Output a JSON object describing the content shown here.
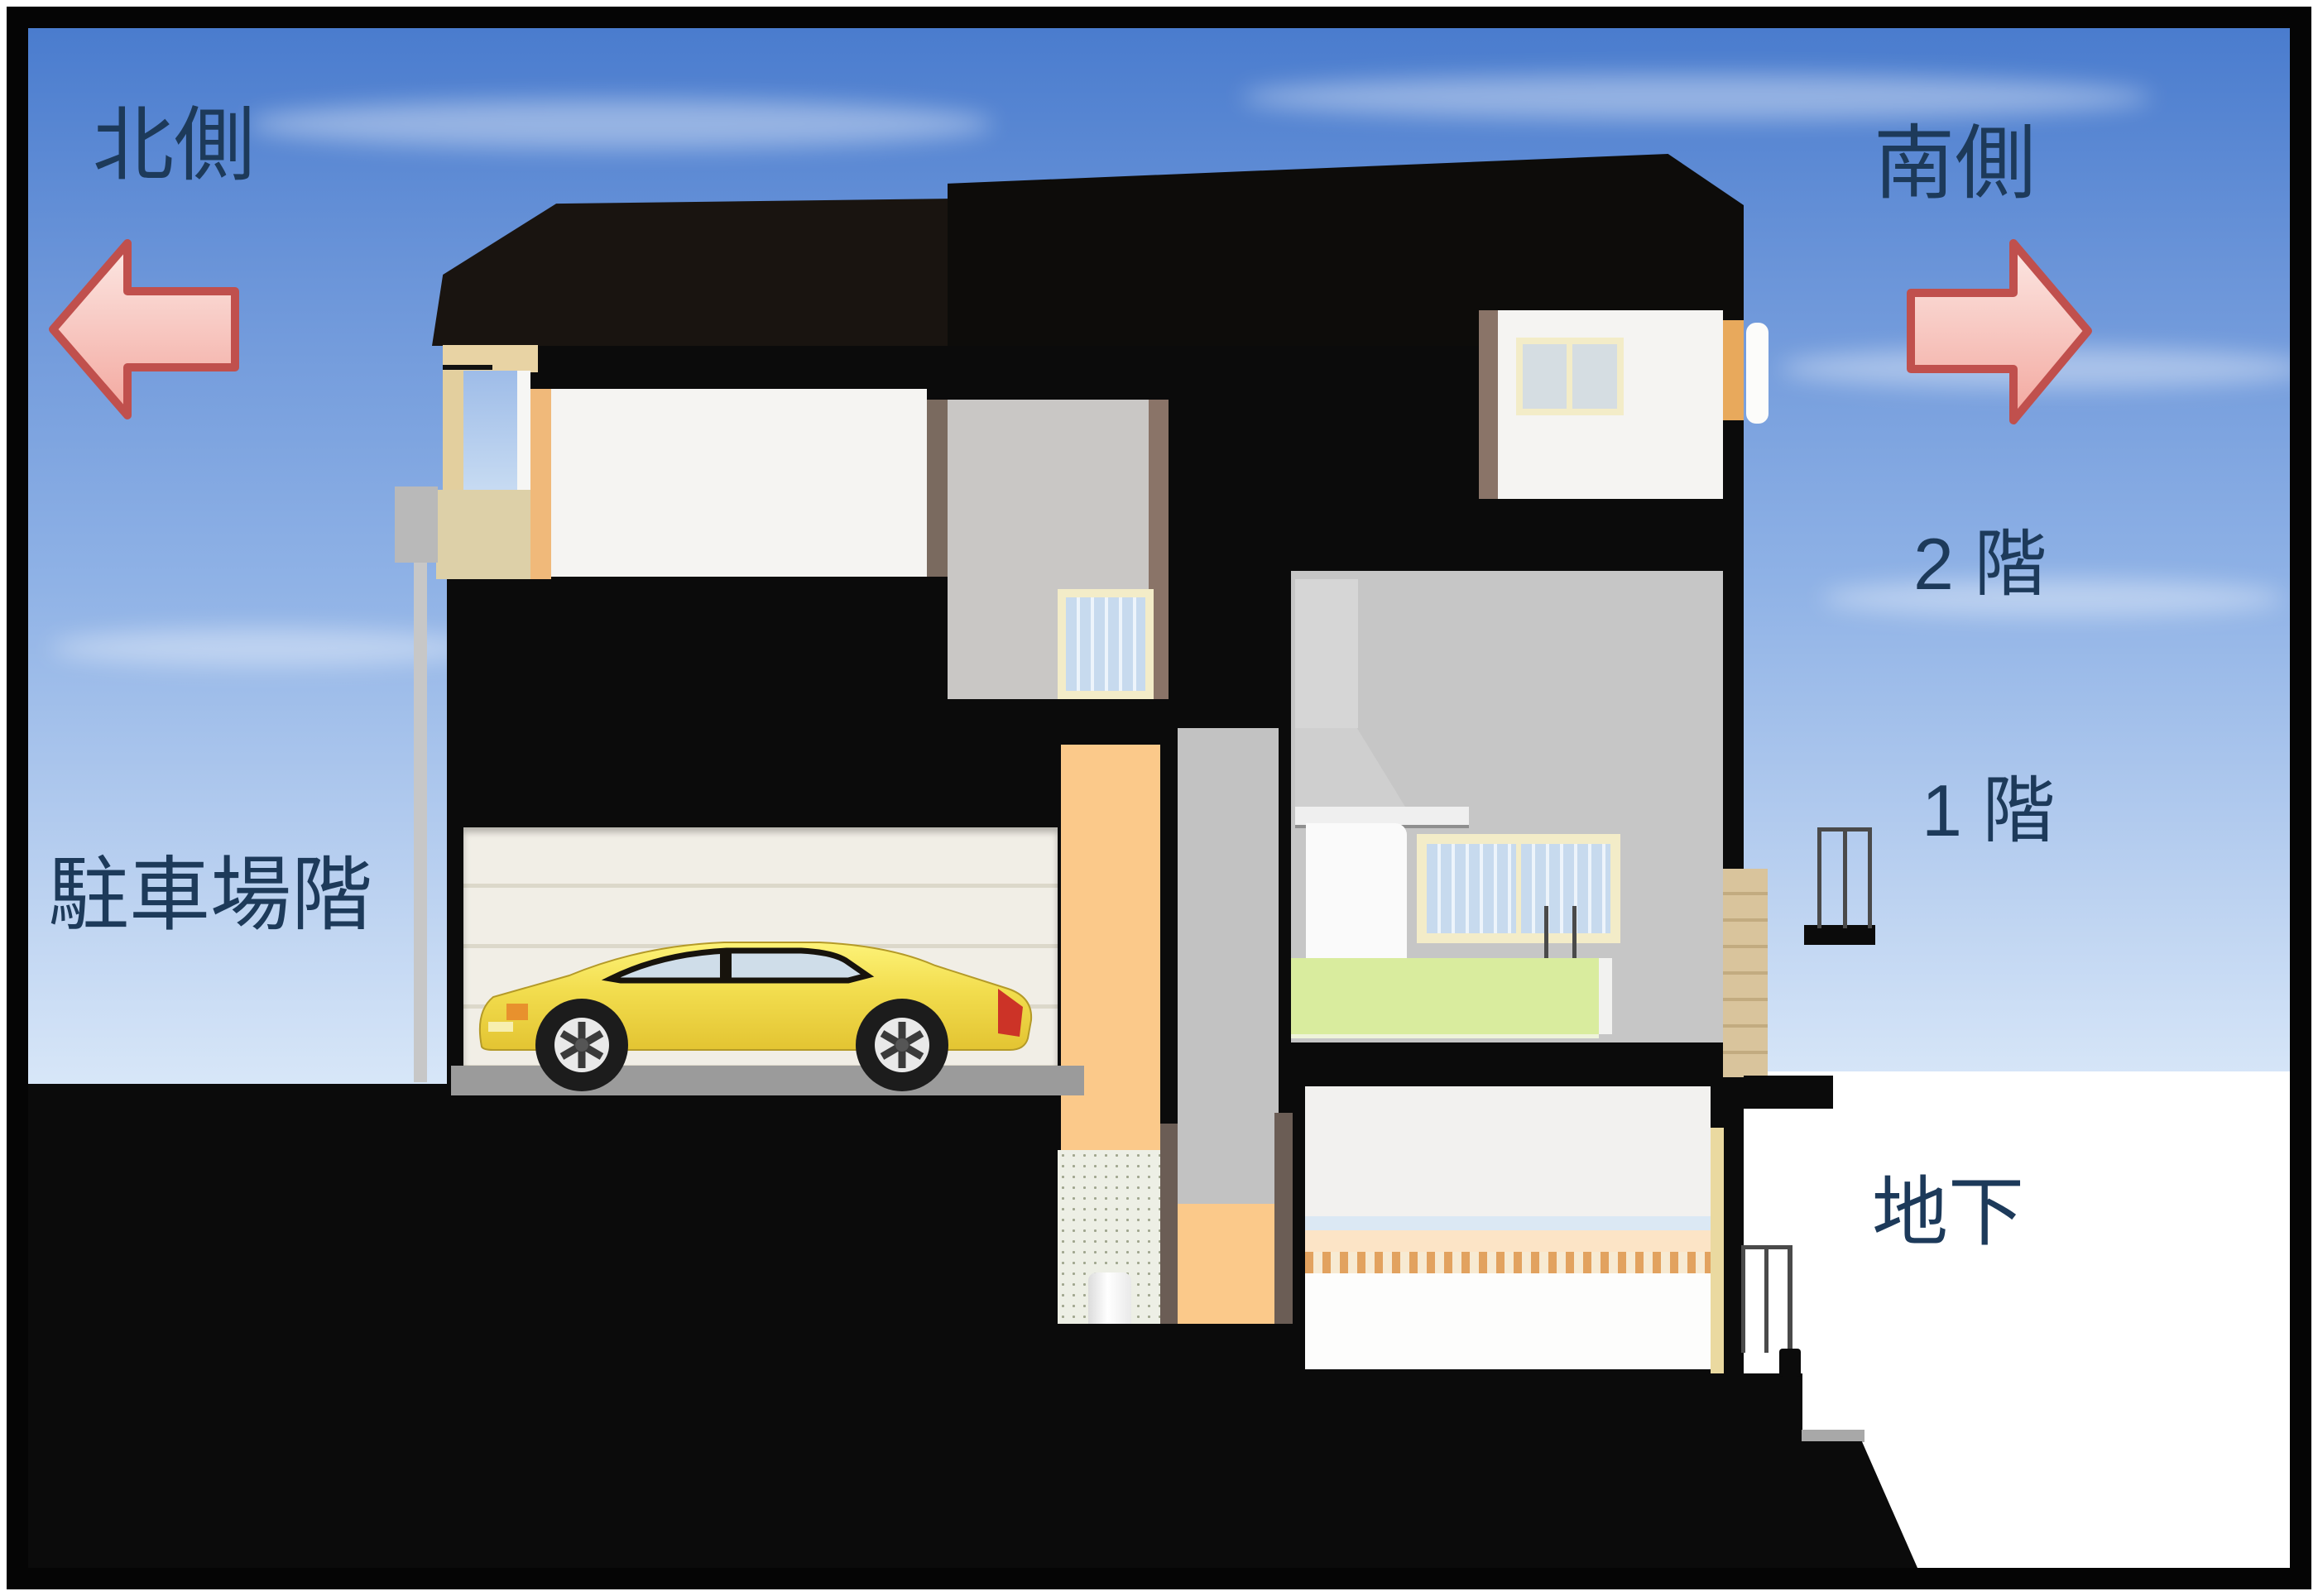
{
  "diagram": {
    "type": "house-cross-section",
    "labels": {
      "north": "北側",
      "south": "南側",
      "floor2": "2 階",
      "floor1": "1 階",
      "basement": "地下",
      "parking": "駐車場階"
    },
    "arrows": {
      "north_direction": "left",
      "south_direction": "right",
      "fill": "#f6b3aa",
      "fill_light": "#fce8e4",
      "stroke": "#c0504d"
    },
    "colors": {
      "label_text": "#1d3a5a",
      "sky_top": "#4a7cce",
      "sky_bottom": "#ffffff",
      "structure_black": "#0b0b0b",
      "room_white": "#f5f4f2",
      "hall_gray": "#c9c7c5",
      "kitchen_gray": "#c6c6c6",
      "stair_orange": "#fbc98a",
      "balcony_tan": "#e6d2a0",
      "garage_door": "#f0ede4",
      "garage_floor": "#9b9b9b",
      "kitchen_counter_green": "#d9ec9e",
      "car_yellow": "#f2dd4e",
      "window_frame_cream": "#f3ecc8",
      "window_blind_blue": "#c7daee"
    },
    "objects": [
      "left-arrow",
      "right-arrow",
      "roof",
      "balcony",
      "stairwell-window",
      "garage",
      "garage-door",
      "car",
      "kitchen",
      "kitchen-window",
      "range-hood",
      "counter",
      "basement-room",
      "railings",
      "earth-section"
    ]
  }
}
